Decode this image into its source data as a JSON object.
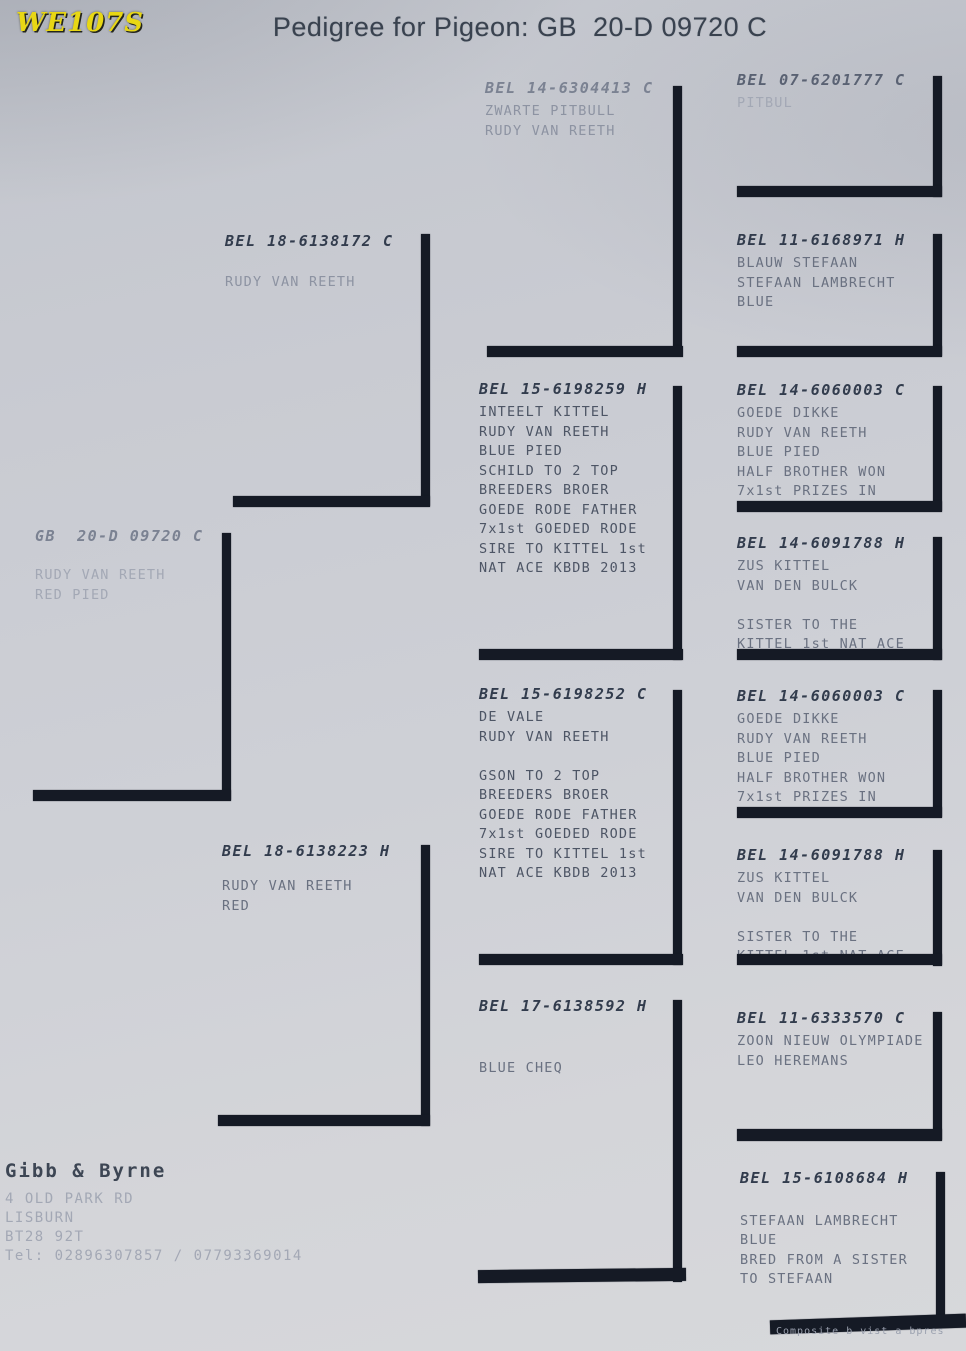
{
  "page": {
    "badge": "WE107S",
    "title": "Pedigree for Pigeon: GB  20-D 09720 C",
    "watermark": "Composite b vist a bpres",
    "badge_color": "#e8d714",
    "line_color": "#151a25",
    "paper_color": "#ced0d6"
  },
  "breeder": {
    "name": "Gibb & Byrne",
    "address_lines": [
      "4 OLD PARK RD",
      "LISBURN",
      "BT28 92T",
      "Tel: 02896307857 / 07793369014"
    ]
  },
  "pedigree": {
    "subject": {
      "ring": "GB  20-D 09720 C",
      "lines": [
        "RUDY VAN REETH",
        "RED PIED"
      ]
    },
    "sire": {
      "ring": "BEL 18-6138172 C",
      "lines": [
        "RUDY VAN REETH"
      ]
    },
    "dam": {
      "ring": "BEL 18-6138223 H",
      "lines": [
        "RUDY VAN REETH",
        "RED"
      ]
    },
    "gen3": [
      {
        "ring": "BEL 14-6304413 C",
        "lines": [
          "ZWARTE PITBULL",
          "RUDY VAN REETH"
        ]
      },
      {
        "ring": "BEL 15-6198259 H",
        "lines": [
          "INTEELT KITTEL",
          "RUDY VAN REETH",
          "BLUE PIED",
          "SCHILD TO 2 TOP",
          "BREEDERS BROER",
          "GOEDE RODE FATHER",
          "7x1st GOEDED RODE",
          "SIRE TO KITTEL 1st",
          "NAT ACE KBDB 2013"
        ]
      },
      {
        "ring": "BEL 15-6198252 C",
        "lines": [
          "DE VALE",
          "RUDY VAN REETH",
          "",
          "GSON TO 2 TOP",
          "BREEDERS BROER",
          "GOEDE RODE FATHER",
          "7x1st GOEDED RODE",
          "SIRE TO KITTEL 1st",
          "NAT ACE KBDB 2013"
        ]
      },
      {
        "ring": "BEL 17-6138592 H",
        "lines": [
          "",
          "",
          "BLUE CHEQ"
        ]
      }
    ],
    "gen4": [
      {
        "ring": "BEL 07-6201777 C",
        "lines": [
          "PITBUL"
        ]
      },
      {
        "ring": "BEL 11-6168971 H",
        "lines": [
          "BLAUW STEFAAN",
          "STEFAAN LAMBRECHT",
          "BLUE"
        ]
      },
      {
        "ring": "BEL 14-6060003 C",
        "lines": [
          "GOEDE DIKKE",
          "RUDY VAN REETH",
          "BLUE PIED",
          "HALF BROTHER WON",
          "7x1st PRIZES IN"
        ]
      },
      {
        "ring": "BEL 14-6091788 H",
        "lines": [
          "ZUS KITTEL",
          "VAN DEN BULCK",
          "",
          "SISTER TO THE",
          "KITTEL 1st NAT ACE"
        ]
      },
      {
        "ring": "BEL 14-6060003 C",
        "lines": [
          "GOEDE DIKKE",
          "RUDY VAN REETH",
          "BLUE PIED",
          "HALF BROTHER WON",
          "7x1st PRIZES IN"
        ]
      },
      {
        "ring": "BEL 14-6091788 H",
        "lines": [
          "ZUS KITTEL",
          "VAN DEN BULCK",
          "",
          "SISTER TO THE",
          "KITTEL 1st NAT ACE"
        ]
      },
      {
        "ring": "BEL 11-6333570 C",
        "lines": [
          "ZOON NIEUW OLYMPIADE",
          "LEO HEREMANS"
        ]
      },
      {
        "ring": "BEL 15-6108684 H",
        "lines": [
          "",
          "STEFAAN LAMBRECHT",
          "BLUE",
          "BRED FROM A SISTER",
          "TO STEFAAN"
        ]
      }
    ]
  }
}
